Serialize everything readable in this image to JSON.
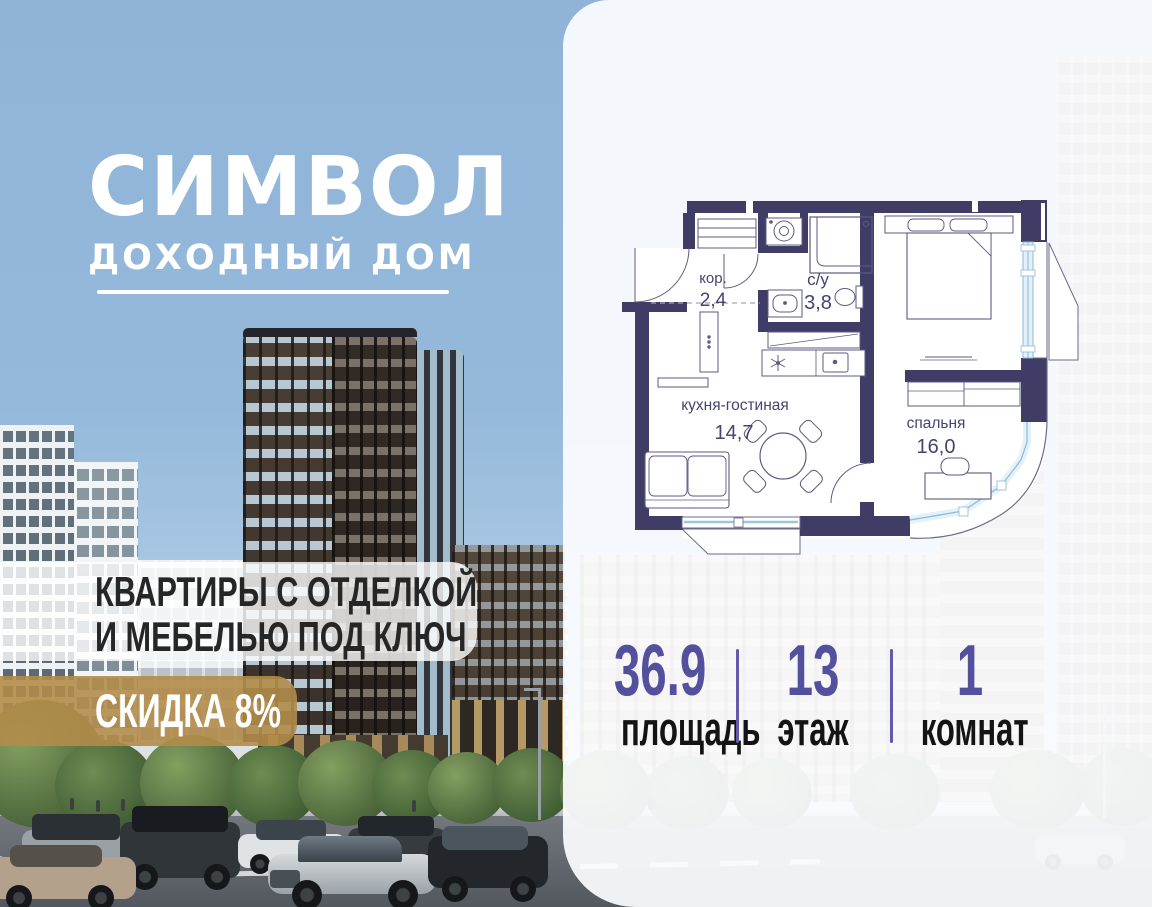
{
  "logo": {
    "title": "СИМВОЛ",
    "subtitle": "ДОХОДНЫЙ ДОМ"
  },
  "promo": {
    "line1": "КВАРТИРЫ С ОТДЕЛКОЙ",
    "line2": "И МЕБЕЛЬЮ ПОД КЛЮЧ"
  },
  "discount": {
    "label": "СКИДКА 8%"
  },
  "floorplan": {
    "rooms": [
      {
        "name": "кор.",
        "area": "2,4"
      },
      {
        "name": "с/у",
        "area": "3,8"
      },
      {
        "name": "кухня-гостиная",
        "area": "14,7"
      },
      {
        "name": "спальня",
        "area": "16,0"
      }
    ]
  },
  "stats": {
    "area": {
      "value": "36.9",
      "label": "площадь"
    },
    "floor": {
      "value": "13",
      "label": "этаж"
    },
    "rooms": {
      "value": "1",
      "label": "комнат"
    }
  },
  "colors": {
    "accent_purple": "#55509d",
    "wall_navy": "#3f3d66",
    "glazing_blue": "#a9cde6",
    "discount_gold": "#b28c49",
    "sky_blue": "#92b7d9"
  }
}
